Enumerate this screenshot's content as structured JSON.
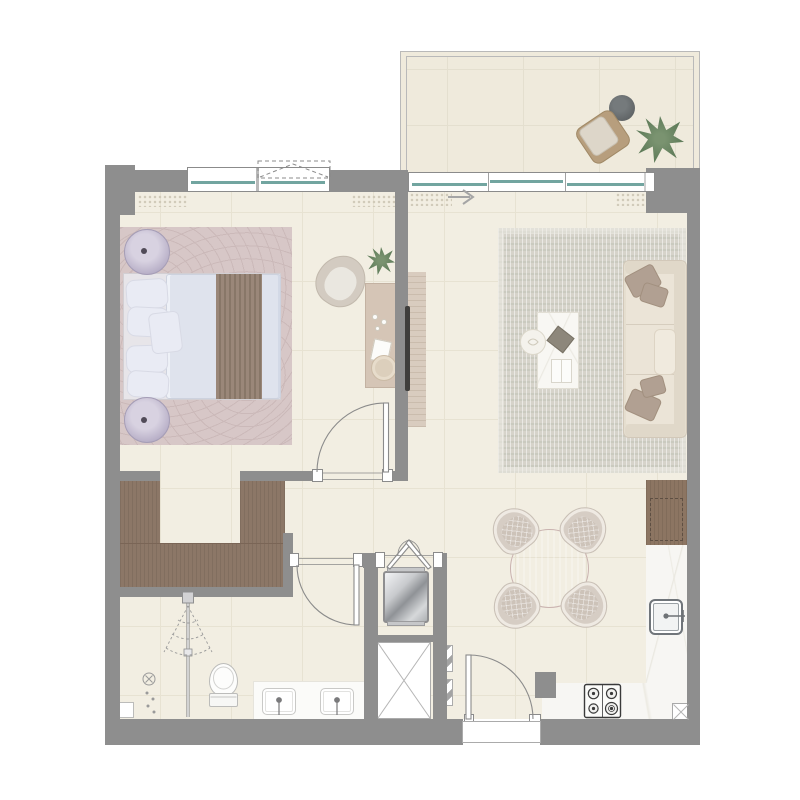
{
  "title": "One-bedroom apartment floor plan with balcony",
  "palette": {
    "paper": "#ffffff",
    "wall": "#8e8e8e",
    "floor": "#f2eee2",
    "grid": "#e7e2d2",
    "balconyFloor": "#efeadc",
    "balconyGrid": "#e4dfcf",
    "rail": "#b9b9b9",
    "line": "#8b8b8b",
    "glass": "#72a5a0",
    "hatch": "#ccc6b4",
    "rugBedroom": "#d7c7c7",
    "rugBedroomPat": "#cbb9b9",
    "rugLiving": "#d6d3ca",
    "woodCloset": "#8c7767",
    "woodCabinet": "#8c7562",
    "woodMedia": "#d9ccbf",
    "counter": "#f7f6f3",
    "sofa": "#e5decf",
    "sofaTrim": "#e0d8c9",
    "pillowAccent": "#b1a092",
    "duvet": "#dfe3ed",
    "bedPillow": "#e9ebf4",
    "throw": "#9a8779",
    "diningTable": "#d7c1be",
    "chairSeat": "#d6cdc4",
    "chairRim": "#efeae3",
    "dark": "#3f3e3c",
    "green": "#7a9370",
    "greenDark": "#5d7a58",
    "sanitary": "#bcbcba",
    "arrow": "#a5a5a5"
  },
  "rooms": {
    "balcony": {
      "furniture": [
        "lounge-chair",
        "round-side-table",
        "potted-plant"
      ]
    },
    "bedroom": {
      "furniture": [
        "double-bed",
        "bedside-table",
        "bedside-table",
        "area-rug",
        "armchair",
        "potted-plant",
        "dresser-console",
        "vanity-stool"
      ],
      "openings": [
        "window",
        "door-to-hallway",
        "walk-in-closet-opening"
      ]
    },
    "walk_in_closet": {
      "furniture": [
        "wardrobe-left",
        "wardrobe-front",
        "wardrobe-right"
      ]
    },
    "living_dining": {
      "furniture": [
        "sofa-3-seat",
        "coffee-table",
        "side-dish-table",
        "tv-on-media-panel",
        "area-rug",
        "dining-table-round",
        "dining-chair",
        "dining-chair",
        "dining-chair",
        "dining-chair"
      ],
      "openings": [
        "sliding-door-to-balcony",
        "entrance-door"
      ]
    },
    "kitchen": {
      "furniture": [
        "tall-cabinet",
        "counter-l-shaped",
        "kitchen-sink",
        "gas-hob-4-burner",
        "floor-duct"
      ],
      "burner_count": 4
    },
    "utility_closet": {
      "furniture": [
        "washing-machine",
        "service-shaft",
        "double-leaf-doors",
        "vent-louvers"
      ]
    },
    "bathroom": {
      "furniture": [
        "shower-column",
        "floor-drain",
        "toilet",
        "vanity-two-basins",
        "shelf-box"
      ],
      "basin_count": 2
    }
  }
}
